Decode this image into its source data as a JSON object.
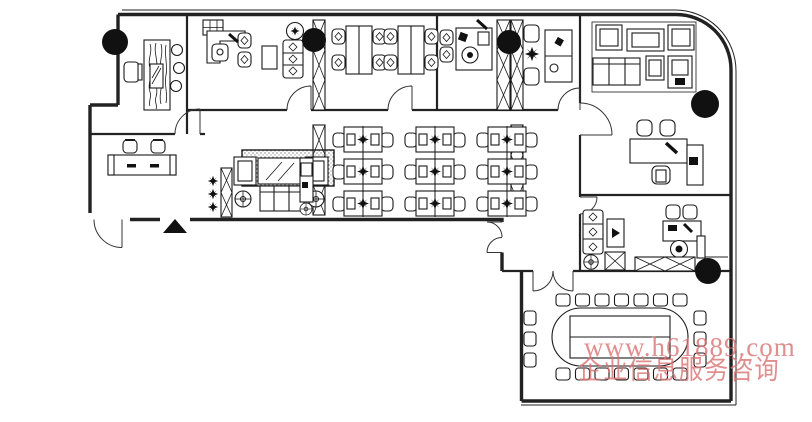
{
  "watermark": {
    "url_text": "www.h61889.com",
    "caption_text": "企业信息服务咨询",
    "color": "#d97272"
  },
  "plan": {
    "canvas": {
      "width": 812,
      "height": 422,
      "background": "#ffffff",
      "line_color": "#1a1a1a"
    },
    "column_markers": [
      {
        "x": 115,
        "y": 42,
        "r": 13
      },
      {
        "x": 314,
        "y": 40,
        "r": 12
      },
      {
        "x": 509,
        "y": 42,
        "r": 12
      },
      {
        "x": 705,
        "y": 104,
        "r": 14
      },
      {
        "x": 708,
        "y": 271,
        "r": 13
      }
    ],
    "structural_columns": [
      {
        "x": 313,
        "y": 20,
        "w": 12,
        "h": 90
      },
      {
        "x": 497,
        "y": 20,
        "w": 13,
        "h": 90
      },
      {
        "x": 511,
        "y": 20,
        "w": 12,
        "h": 90
      },
      {
        "x": 313,
        "y": 125,
        "w": 12,
        "h": 90
      },
      {
        "x": 511,
        "y": 125,
        "w": 12,
        "h": 90
      },
      {
        "x": 221,
        "y": 168,
        "w": 11,
        "h": 49
      }
    ],
    "workstation_grid": {
      "col_x": [
        333,
        405,
        477
      ],
      "row_y": [
        126,
        158,
        190
      ],
      "cluster_width": 60,
      "cluster_height": 27,
      "rows": 3,
      "cols": 3
    },
    "conference": {
      "table": {
        "x": 552,
        "y": 308,
        "width": 136,
        "height": 58,
        "corner_radius": 29
      },
      "chairs": {
        "top": 7,
        "bottom": 7,
        "left": 3,
        "right": 3,
        "total": 20
      }
    }
  }
}
